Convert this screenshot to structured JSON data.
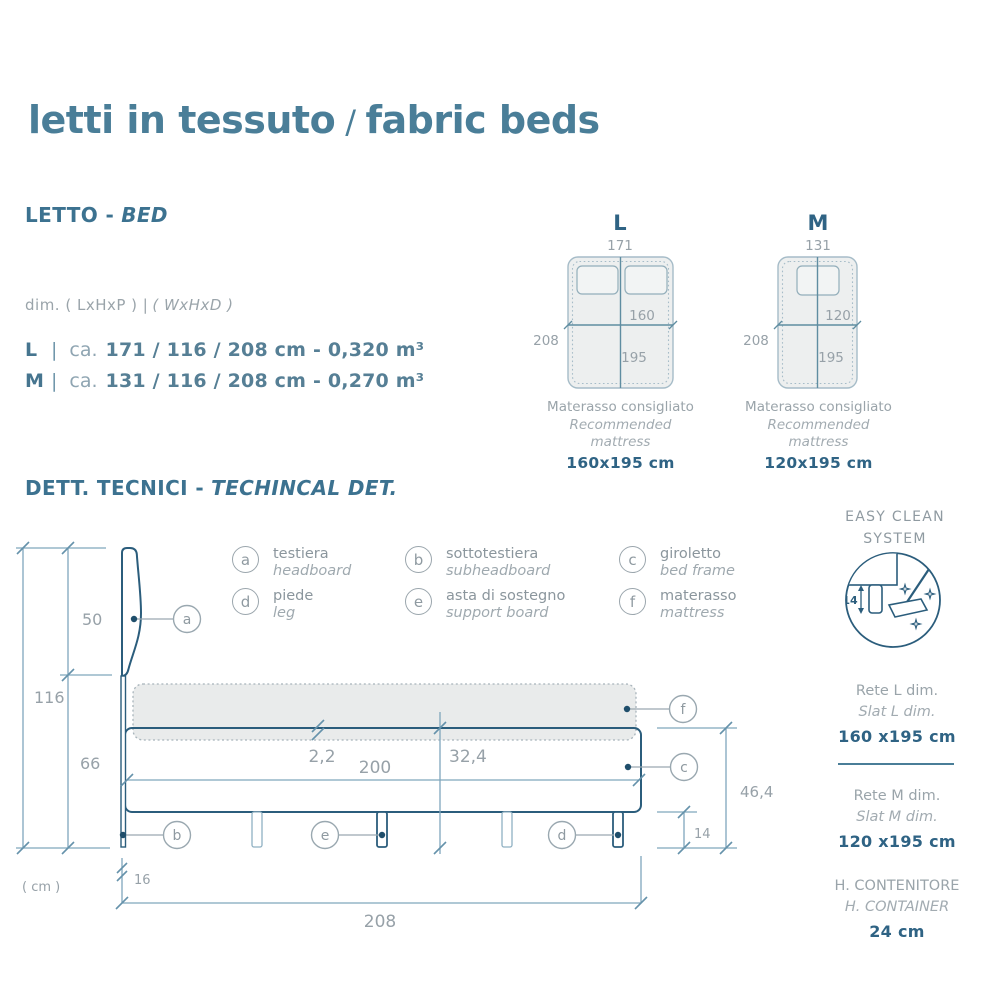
{
  "colors": {
    "teal_heading": "#4a7e98",
    "dark_teal_value": "#2f6384",
    "drawing_dark": "#2b5d7c",
    "dimension_line": "#7fa6bc",
    "gray_text": "#97a1a8",
    "bed_fill": "#edefef",
    "mattress_fill": "#e9ebeb"
  },
  "header": {
    "title_it": "letti in tessuto",
    "title_sep": "/",
    "title_en": "fabric beds"
  },
  "letto": {
    "heading_it": "LETTO -",
    "heading_en": "BED",
    "dim_label_prefix": "dim. ( LxHxP ) |",
    "dim_label_italic": "( WxHxD )",
    "specs": [
      {
        "size": "L",
        "sep": "|",
        "approx": "ca.",
        "dims": "171 / 116 / 208 cm - 0,320 m³"
      },
      {
        "size": "M",
        "sep": "|",
        "approx": "ca.",
        "dims": "131 / 116 / 208 cm - 0,270 m³"
      }
    ]
  },
  "diagrams": {
    "l": {
      "label": "L",
      "top_dim": "171",
      "side_dim": "208",
      "width_dim": "160",
      "length_dim": "195",
      "caption_it": "Materasso consigliato",
      "caption_en": "Recommended mattress",
      "size": "160x195 cm"
    },
    "m": {
      "label": "M",
      "top_dim": "131",
      "side_dim": "208",
      "width_dim": "120",
      "length_dim": "195",
      "caption_it": "Materasso consigliato",
      "caption_en": "Recommended mattress",
      "size": "120x195 cm"
    }
  },
  "tech": {
    "heading_it": "DETT. TECNICI -",
    "heading_en": "TECHINCAL DET.",
    "legend": [
      {
        "key": "a",
        "it": "testiera",
        "en": "headboard"
      },
      {
        "key": "b",
        "it": "sottotestiera",
        "en": "subheadboard"
      },
      {
        "key": "c",
        "it": "giroletto",
        "en": "bed frame"
      },
      {
        "key": "d",
        "it": "piede",
        "en": "leg"
      },
      {
        "key": "e",
        "it": "asta di sostegno",
        "en": "support board"
      },
      {
        "key": "f",
        "it": "materasso",
        "en": "mattress"
      }
    ],
    "dims": {
      "total_height": "116",
      "headboard_height": "50",
      "base_height": "66",
      "unit": "( cm )",
      "gap": "2,2",
      "inner_length": "200",
      "frame_height": "32,4",
      "side_height": "46,4",
      "leg_height": "14",
      "back_depth": "16",
      "total_length": "208"
    }
  },
  "easy_clean": {
    "line1": "EASY CLEAN",
    "line2": "SYSTEM",
    "leg_dim": "14"
  },
  "panel": {
    "slat_l": {
      "it": "Rete L dim.",
      "en": "Slat L dim.",
      "value": "160 x195 cm"
    },
    "slat_m": {
      "it": "Rete M dim.",
      "en": "Slat M dim.",
      "value": "120 x195 cm"
    },
    "container": {
      "it": "H. CONTENITORE",
      "en": "H. CONTAINER",
      "value": "24 cm"
    }
  }
}
